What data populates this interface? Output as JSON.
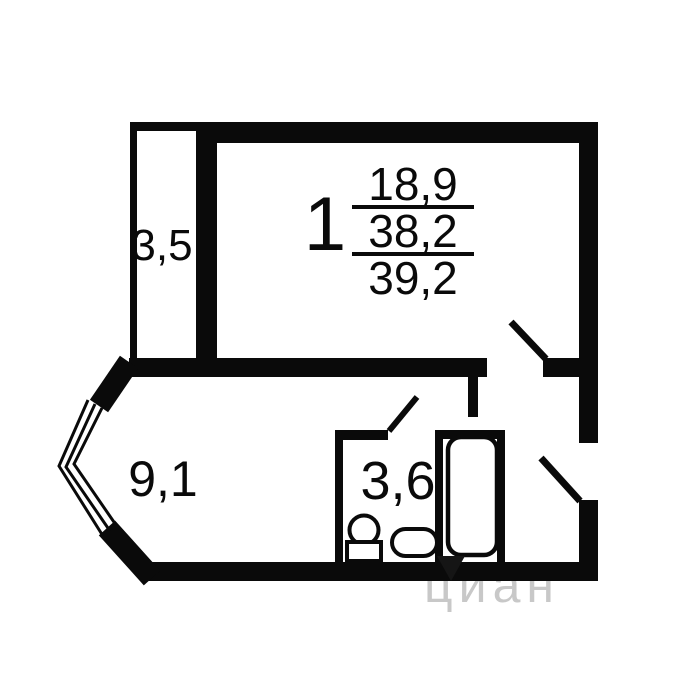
{
  "labels": {
    "room_number": "1",
    "living_area": "18,9",
    "total_area": "38,2",
    "total_area_with_balcony": "39,2",
    "balcony_area": "3,5",
    "hallway_area": "9,1",
    "bathroom_area": "3,6"
  },
  "watermark": {
    "text": "циан",
    "pin_icon": "location-pin"
  },
  "colors": {
    "wall": "#0a0a0a",
    "background": "#ffffff",
    "watermark_light": "#c8c8c8"
  }
}
